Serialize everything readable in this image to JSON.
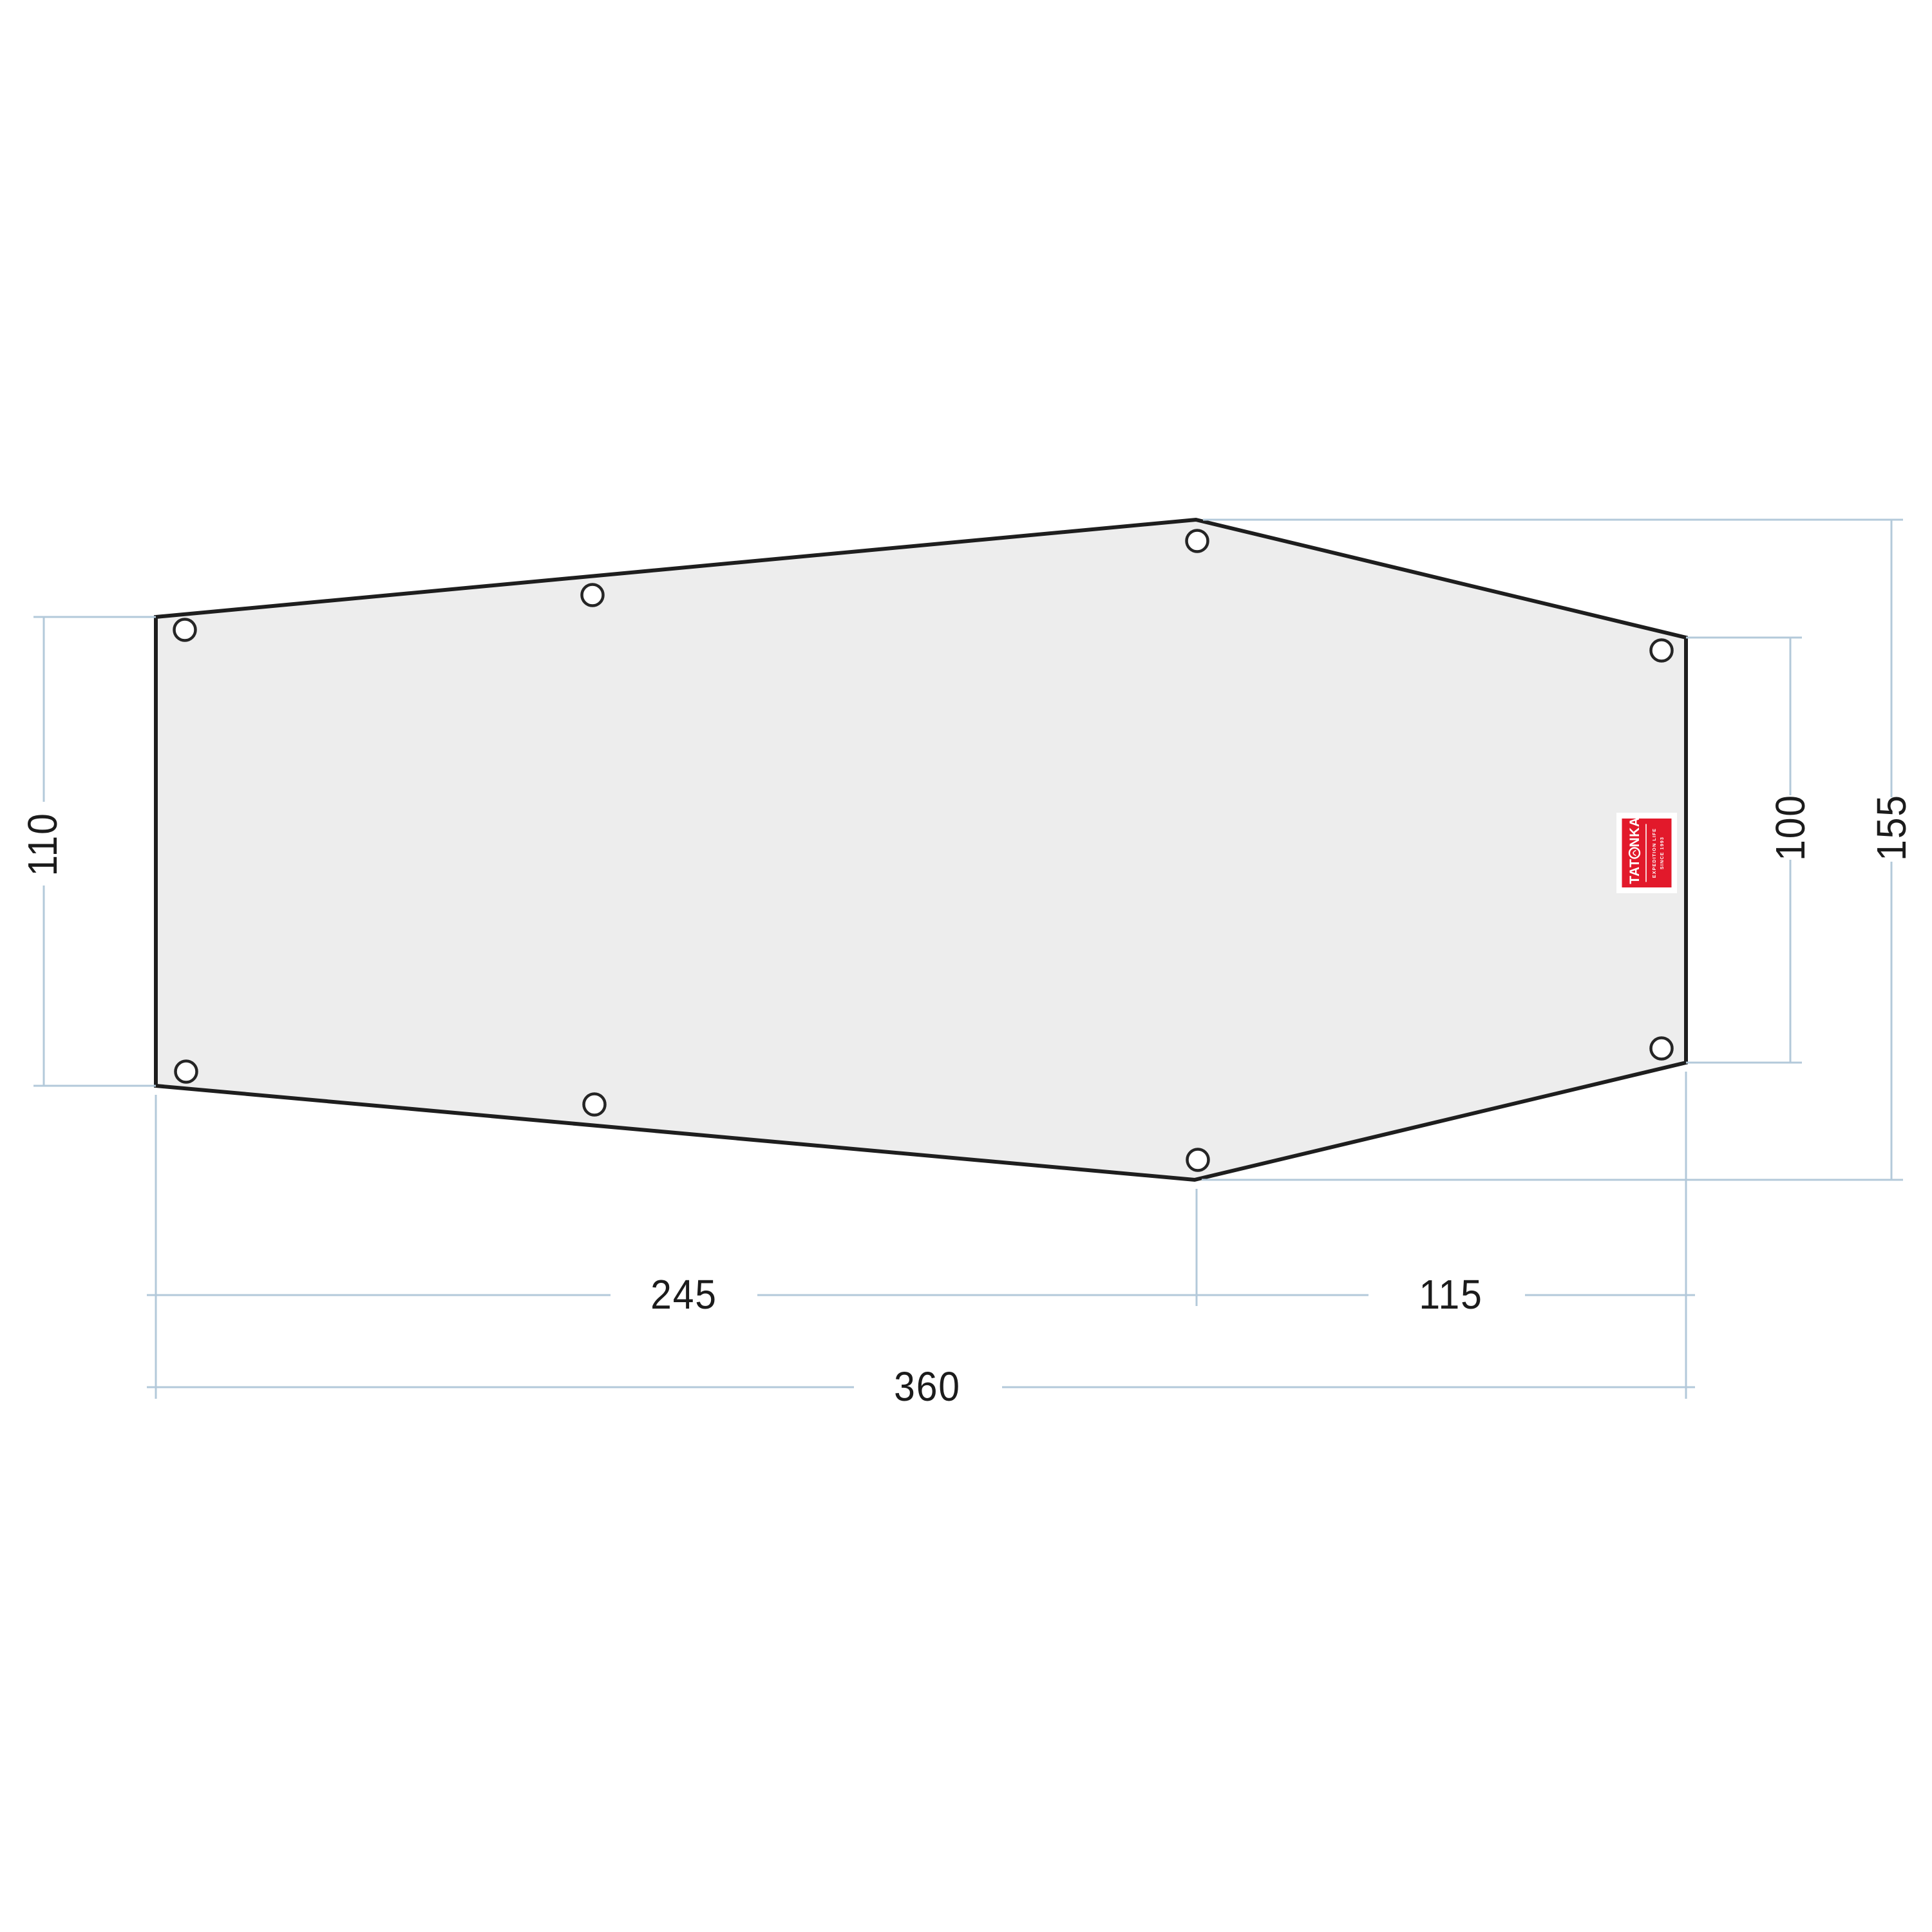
{
  "colors": {
    "dimension_line": "#b3c9da",
    "outline": "#1e1e1e",
    "fabric_fill": "#ededed",
    "logo_red": "#e2192b",
    "label_text": "#1b1b1b"
  },
  "dimensions": {
    "left_height": "110",
    "inner_right_height": "100",
    "total_height": "155",
    "bottom_left_width": "245",
    "bottom_right_width": "115",
    "total_width": "360"
  },
  "logo": {
    "brand_full": "TATONKA",
    "brand_prefix": "TAT",
    "brand_suffix": "NKA",
    "tagline_line1": "EXPEDITION LIFE",
    "tagline_line2": "SINCE 1993"
  }
}
